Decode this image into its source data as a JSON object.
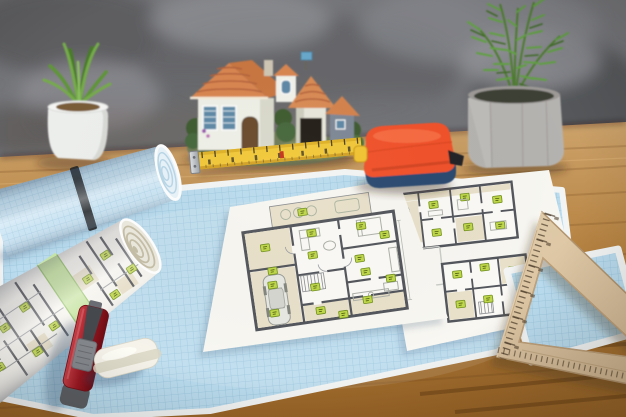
{
  "meta": {
    "domain": "Natural-Image",
    "description": "Angled photograph of an architect's wooden desk: a large blue graph-paper mat with white apartment floor-plan sheets, a rolled blueprint and rolled graph paper, a miniature house model, two potted plants against a gray concrete wall, a yellow tape blade with orange tape-measure body, a wooden triangular set square, a red utility knife and a white eraser.",
    "width_px": 626,
    "height_px": 417,
    "visible_text": "none — ruler scale numbers and tape markings are present but illegible at this resolution"
  },
  "palette": {
    "wall_gray": "#75767a",
    "wall_dark": "#55565a",
    "wall_light": "#909196",
    "desk_light": "#c99e66",
    "desk_dark": "#9e682c",
    "desk_grain": "#6e441a",
    "mat_blue": "#badcee",
    "mat_grid": "#98c3da",
    "mat_edge": "#f3f5f5",
    "roll_blue": "#c9e4f4",
    "roll_grid": "#a6cde2",
    "roll_band_black": "#222326",
    "roll_band_green": "#c8e5a3",
    "plan_paper": "#f8f7f2",
    "plan_wall": "#53565c",
    "plan_line": "#9a9da2",
    "plan_room_beige": "#e9e1ca",
    "plan_marker_fill": "#c0d84a",
    "plan_marker_edge": "#71901e",
    "house_roof": "#d9854f",
    "house_roof_dark": "#b2613a",
    "house_wall": "#eff0e7",
    "house_window_blue": "#5d88a6",
    "house_dark_opening": "#241c13",
    "foliage_dark": "#3d5a2e",
    "foliage_mid": "#558733",
    "foliage_light": "#79ab4b",
    "pot_white": "#eef0ee",
    "pot_concrete": "#b5b3b0",
    "tape_body_orange": "#f1512b",
    "tape_body_navy": "#2a486f",
    "tape_blade_yellow": "#f2c838",
    "tape_hook_metal": "#c3c7cb",
    "ruler_wood": "#d8c2a1",
    "ruler_wood_edge": "#b2946e",
    "knife_red": "#a31e28",
    "knife_gray": "#85888d",
    "eraser_white": "#f5f3ea"
  },
  "objects": [
    {
      "id": "concrete-wall",
      "label": "mottled gray concrete wall background",
      "position": "top"
    },
    {
      "id": "wooden-desk",
      "label": "warm brown wooden desktop with grain streaks",
      "position": "full lower area"
    },
    {
      "id": "potted-succulent-left",
      "label": "green succulent in a white ceramic pot",
      "position": "upper left"
    },
    {
      "id": "miniature-house-model",
      "label": "miniature house model with orange tiled roofs, white walls, blue shuttered windows and flowering garden base",
      "position": "upper center"
    },
    {
      "id": "potted-fern-right",
      "label": "feathery green plant in a faceted gray concrete pot",
      "position": "upper right"
    },
    {
      "id": "blue-grid-paper-roll",
      "label": "roll of blue graph paper with a black elastic band",
      "position": "left, on the mat"
    },
    {
      "id": "rolled-floor-plan",
      "label": "rolled white floor-plan print with green elastic band and green room labels",
      "position": "lower left, in front of the blue roll"
    },
    {
      "id": "blue-grid-mat",
      "label": "large blue graph-paper sheet used as a desk mat",
      "position": "center"
    },
    {
      "id": "center-floor-plan-sheet",
      "label": "white sheet with a large apartment floor plan: beige rooms, terrace at top, garage with car bottom-left, green room labels",
      "position": "center"
    },
    {
      "id": "right-floor-plan-sheet",
      "label": "white sheet with two smaller apartment floor plans, an empty plan frame and green room labels",
      "position": "center right"
    },
    {
      "id": "yellow-tape-blade",
      "label": "extended yellow measuring-tape blade with black markings and metal end hook",
      "position": "center, in front of house model"
    },
    {
      "id": "tape-measure-body",
      "label": "tape measure with orange top shell, navy base and yellow side button",
      "position": "center right"
    },
    {
      "id": "utility-knife",
      "label": "dark red utility knife with gray slider",
      "position": "lower left, on the mat"
    },
    {
      "id": "eraser",
      "label": "white rounded eraser",
      "position": "lower left, on the mat"
    },
    {
      "id": "wooden-set-square",
      "label": "wooden triangular set-square ruler with tick scale and triangular cutout",
      "position": "right"
    },
    {
      "id": "small-grid-sheet",
      "label": "small blue graph-paper sheet under the set square",
      "position": "right"
    }
  ]
}
